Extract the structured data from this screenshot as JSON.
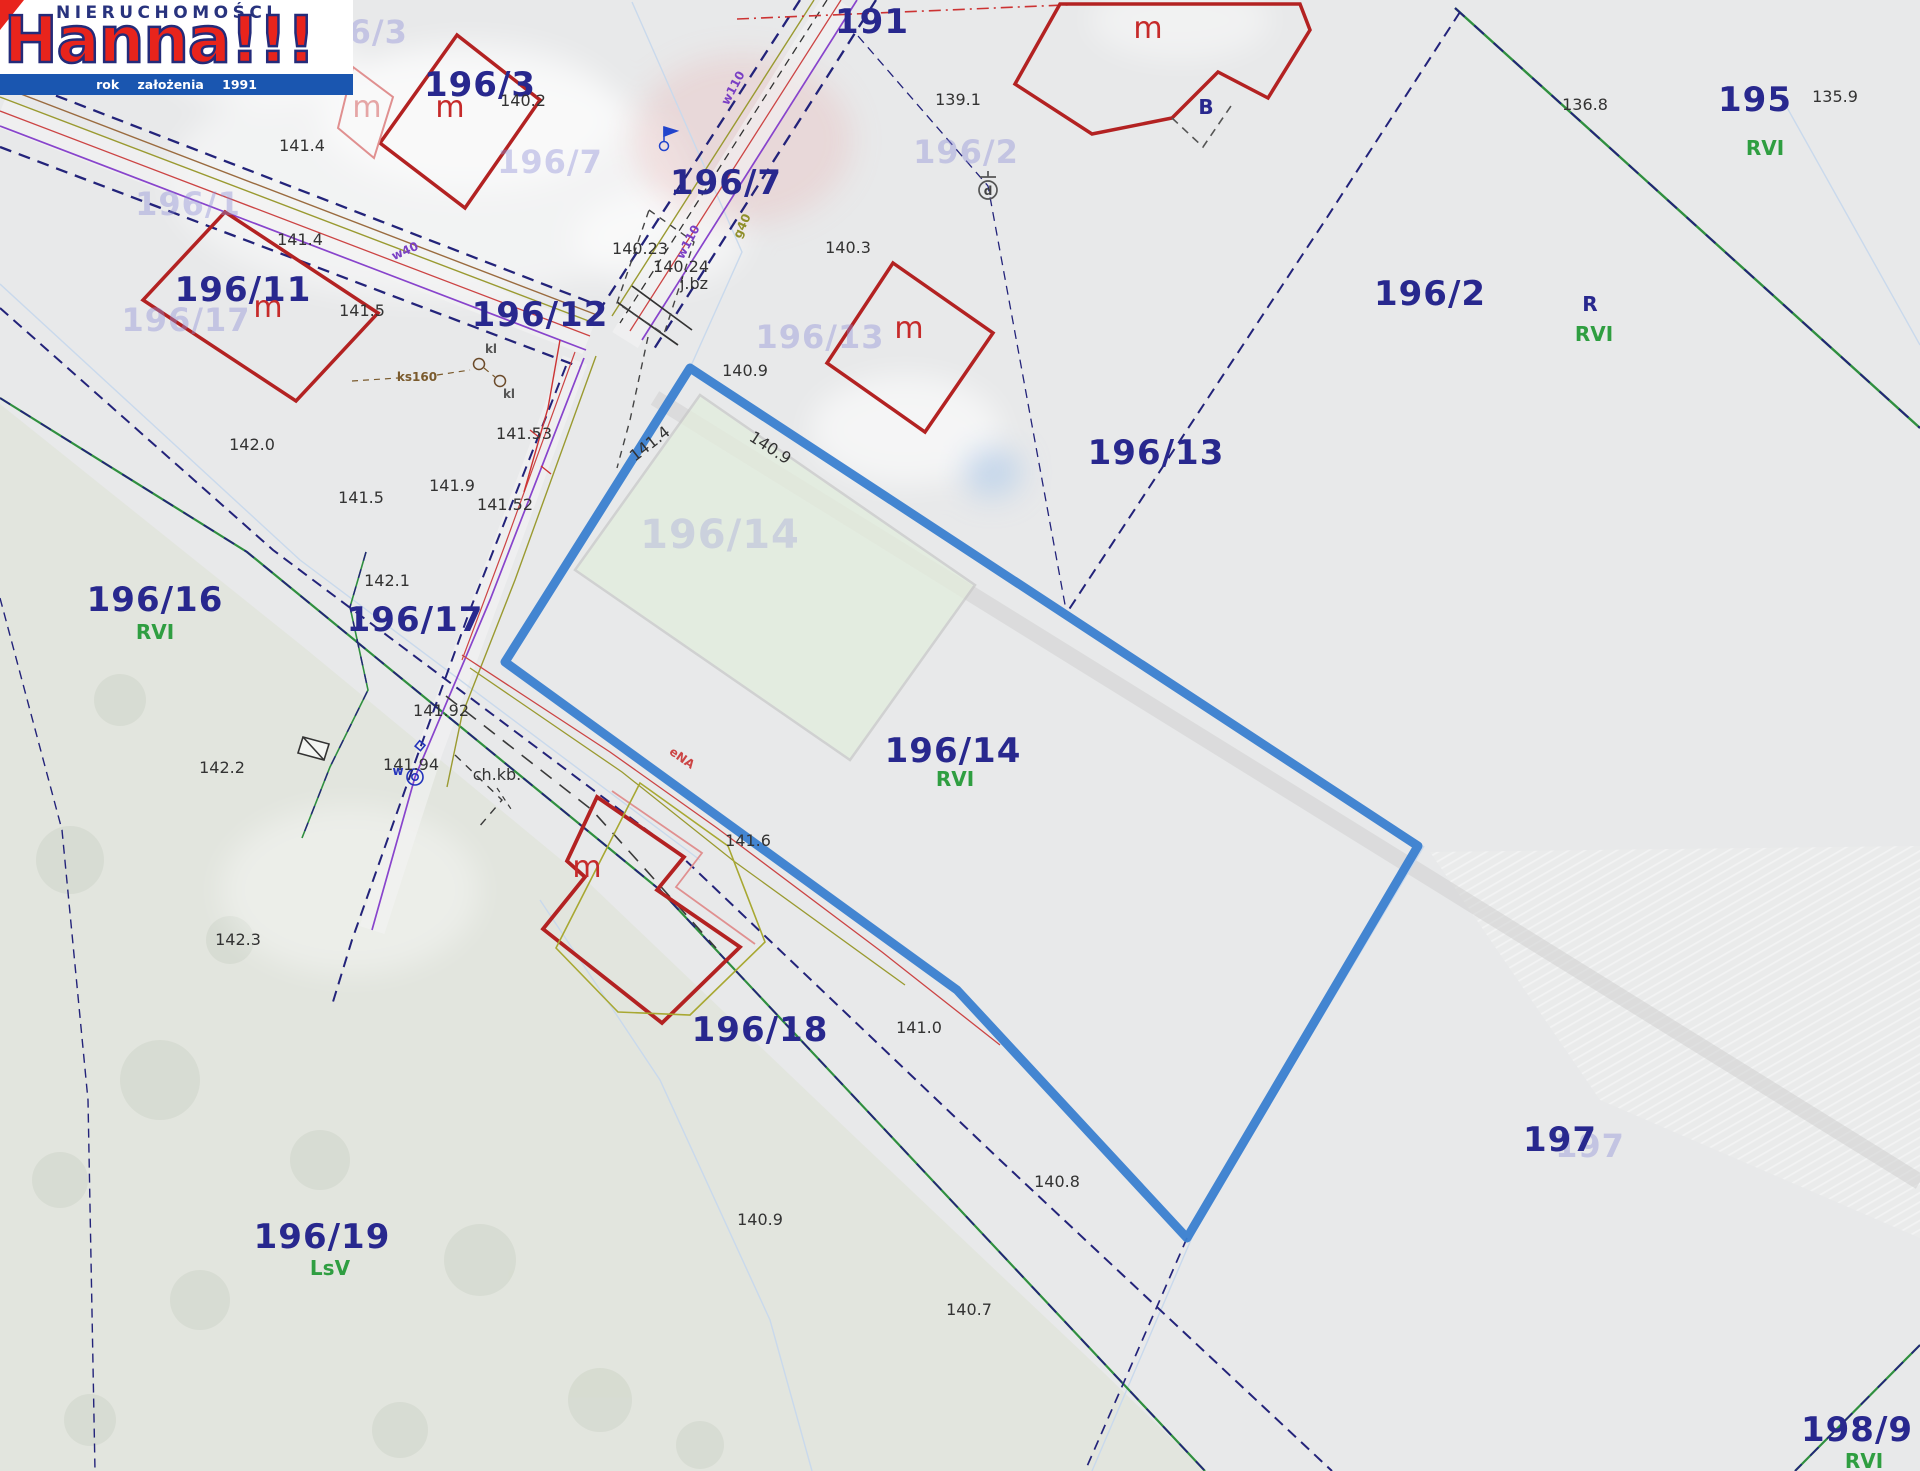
{
  "app": {
    "title": "Hanna!!! Nieruchomości"
  },
  "logo": {
    "top_text": "NIERUCHOMOŚCI",
    "brand_name": "Hanna!!!",
    "tagline": "rok założenia 1991",
    "brand_red": "#e8241c",
    "brand_navy": "#232b7a",
    "bar_blue": "#1a56b0"
  },
  "map": {
    "highlight_color": "#3a7fd0",
    "parcel_color": "#28288e",
    "soil_color": "#2f9e41",
    "building_color": "#b32222",
    "parcels": [
      {
        "t": "191",
        "x": 872,
        "y": 22
      },
      {
        "t": "196/3",
        "x": 480,
        "y": 85
      },
      {
        "t": "196/7",
        "x": 726,
        "y": 183
      },
      {
        "t": "196/11",
        "x": 243,
        "y": 290
      },
      {
        "t": "196/12",
        "x": 540,
        "y": 315
      },
      {
        "t": "196/13",
        "x": 1156,
        "y": 453
      },
      {
        "t": "196/2",
        "x": 1430,
        "y": 294
      },
      {
        "t": "195",
        "x": 1755,
        "y": 100
      },
      {
        "t": "196/16",
        "x": 155,
        "y": 600
      },
      {
        "t": "196/17",
        "x": 415,
        "y": 620
      },
      {
        "t": "196/14",
        "x": 953,
        "y": 751
      },
      {
        "t": "196/18",
        "x": 760,
        "y": 1030
      },
      {
        "t": "196/19",
        "x": 322,
        "y": 1237
      },
      {
        "t": "197",
        "x": 1560,
        "y": 1140
      },
      {
        "t": "198/9",
        "x": 1857,
        "y": 1430
      },
      {
        "t": "R",
        "x": 1590,
        "y": 304,
        "small": true
      },
      {
        "t": "B",
        "x": 1206,
        "y": 107,
        "small": true
      }
    ],
    "faint_parcels": [
      {
        "t": "196/3",
        "x": 355,
        "y": 32
      },
      {
        "t": "196/7",
        "x": 550,
        "y": 162
      },
      {
        "t": "196/2",
        "x": 966,
        "y": 152
      },
      {
        "t": "196/13",
        "x": 820,
        "y": 337
      },
      {
        "t": "196/1",
        "x": 188,
        "y": 204
      },
      {
        "t": "196/17",
        "x": 186,
        "y": 320
      },
      {
        "t": "196/14",
        "x": 720,
        "y": 535,
        "big": true
      },
      {
        "t": "197",
        "x": 1590,
        "y": 1146
      }
    ],
    "soil_classes": [
      {
        "t": "RVI",
        "x": 1765,
        "y": 148
      },
      {
        "t": "RVI",
        "x": 1594,
        "y": 334
      },
      {
        "t": "RVI",
        "x": 155,
        "y": 632
      },
      {
        "t": "RVI",
        "x": 955,
        "y": 779
      },
      {
        "t": "LsV",
        "x": 330,
        "y": 1268
      },
      {
        "t": "RVI",
        "x": 1864,
        "y": 1461
      }
    ],
    "elevations": [
      {
        "t": "140.2",
        "x": 523,
        "y": 101
      },
      {
        "t": "139.1",
        "x": 958,
        "y": 100
      },
      {
        "t": "136.8",
        "x": 1585,
        "y": 105
      },
      {
        "t": "135.9",
        "x": 1835,
        "y": 97
      },
      {
        "t": "141.4",
        "x": 302,
        "y": 146
      },
      {
        "t": "141.4",
        "x": 300,
        "y": 240
      },
      {
        "t": "141.5",
        "x": 362,
        "y": 311
      },
      {
        "t": "140.23",
        "x": 640,
        "y": 249
      },
      {
        "t": "140.24",
        "x": 681,
        "y": 267
      },
      {
        "t": "j.bz",
        "x": 694,
        "y": 284
      },
      {
        "t": "140.3",
        "x": 848,
        "y": 248
      },
      {
        "t": "140.9",
        "x": 745,
        "y": 371
      },
      {
        "t": "140.9",
        "x": 770,
        "y": 448,
        "r": 33
      },
      {
        "t": "141.4",
        "x": 650,
        "y": 444,
        "r": -38
      },
      {
        "t": "142.0",
        "x": 252,
        "y": 445
      },
      {
        "t": "141.5",
        "x": 361,
        "y": 498
      },
      {
        "t": "141.9",
        "x": 452,
        "y": 486
      },
      {
        "t": "141.53",
        "x": 524,
        "y": 434
      },
      {
        "t": "141.52",
        "x": 505,
        "y": 505
      },
      {
        "t": "142.1",
        "x": 387,
        "y": 581
      },
      {
        "t": "141.92",
        "x": 441,
        "y": 711
      },
      {
        "t": "141.94",
        "x": 411,
        "y": 765
      },
      {
        "t": "ch.kb.",
        "x": 497,
        "y": 775
      },
      {
        "t": "141.6",
        "x": 748,
        "y": 841
      },
      {
        "t": "142.2",
        "x": 222,
        "y": 768
      },
      {
        "t": "142.3",
        "x": 238,
        "y": 940
      },
      {
        "t": "141.0",
        "x": 919,
        "y": 1028
      },
      {
        "t": "140.8",
        "x": 1057,
        "y": 1182
      },
      {
        "t": "140.9",
        "x": 760,
        "y": 1220
      },
      {
        "t": "140.7",
        "x": 969,
        "y": 1310
      }
    ],
    "building_marks": [
      {
        "t": "m",
        "x": 450,
        "y": 108
      },
      {
        "t": "m",
        "x": 268,
        "y": 308
      },
      {
        "t": "m",
        "x": 1148,
        "y": 29
      },
      {
        "t": "m",
        "x": 909,
        "y": 329
      },
      {
        "t": "m",
        "x": 587,
        "y": 868
      },
      {
        "t": "m",
        "x": 367,
        "y": 108,
        "pink": true
      }
    ],
    "utility_labels": [
      {
        "t": "w110",
        "x": 733,
        "y": 88,
        "r": -62,
        "c": "#7a3fc4"
      },
      {
        "t": "w110",
        "x": 688,
        "y": 242,
        "r": -62,
        "c": "#7a3fc4"
      },
      {
        "t": "w40",
        "x": 405,
        "y": 251,
        "r": -24,
        "c": "#7a3fc4"
      },
      {
        "t": "g40",
        "x": 742,
        "y": 226,
        "r": -65,
        "c": "#8f8f2a"
      },
      {
        "t": "eNA",
        "x": 682,
        "y": 758,
        "r": 35,
        "c": "#cc4444"
      },
      {
        "t": "ks160",
        "x": 417,
        "y": 377,
        "c": "#7a5a2c"
      },
      {
        "t": "kl",
        "x": 491,
        "y": 349,
        "c": "#555555"
      },
      {
        "t": "kl",
        "x": 509,
        "y": 394,
        "c": "#555555"
      },
      {
        "t": "w",
        "x": 398,
        "y": 771,
        "c": "#2233bb"
      },
      {
        "t": "d",
        "x": 988,
        "y": 191,
        "c": "#444444"
      }
    ]
  }
}
